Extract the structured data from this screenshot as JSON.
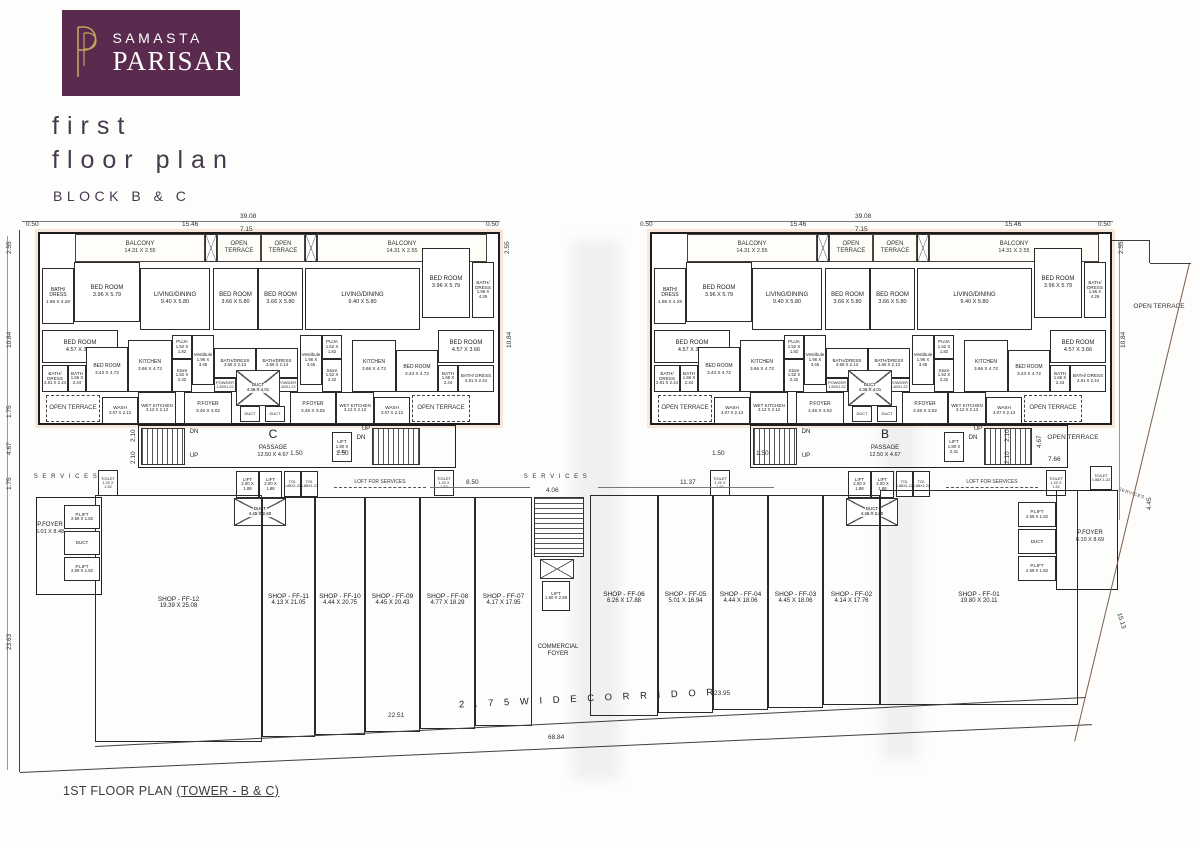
{
  "header": {
    "brand_line1": "SAMASTA",
    "brand_line2": "PARISAR",
    "title_line1": "first",
    "title_line2": "floor plan",
    "subtitle": "BLOCK B & C",
    "logo_bg": "#5a2b4e",
    "logo_gold": "#c9a15f",
    "title_color": "#46394e"
  },
  "footer": {
    "caption_plain": "1ST FLOOR PLAN ",
    "caption_underline": "(TOWER - B & C)"
  },
  "plan": {
    "oy": 232,
    "towers": [
      {
        "id": "C",
        "ox": 38
      },
      {
        "id": "B",
        "ox": 650
      }
    ],
    "tower_rooms": [
      {
        "c": "room open",
        "n": "BALCONY",
        "d": "14.31 X 2.55",
        "x": 37,
        "y": 2,
        "w": 130,
        "h": 28
      },
      {
        "c": "xbox",
        "x": 167,
        "y": 2,
        "w": 12,
        "h": 28
      },
      {
        "c": "room open",
        "n": "OPEN TERRACE",
        "x": 179,
        "y": 2,
        "w": 44,
        "h": 28
      },
      {
        "c": "room open",
        "n": "OPEN TERRACE",
        "x": 223,
        "y": 2,
        "w": 44,
        "h": 28
      },
      {
        "c": "xbox",
        "x": 267,
        "y": 2,
        "w": 12,
        "h": 28
      },
      {
        "c": "room open",
        "n": "BALCONY",
        "d": "14.31 X 2.55",
        "x": 279,
        "y": 2,
        "w": 170,
        "h": 28
      },
      {
        "c": "room sm",
        "n": "BATH/ DRESS",
        "d": "1.96 X 4.29",
        "x": 4,
        "y": 36,
        "w": 32,
        "h": 56
      },
      {
        "c": "room",
        "n": "BED ROOM",
        "d": "3.96 X 5.79",
        "x": 36,
        "y": 30,
        "w": 66,
        "h": 60
      },
      {
        "c": "room",
        "n": "LIVING/DINING",
        "d": "9.40 X 5.80",
        "x": 102,
        "y": 36,
        "w": 70,
        "h": 62
      },
      {
        "c": "room",
        "n": "BED ROOM",
        "d": "3.66 X 5.80",
        "x": 175,
        "y": 36,
        "w": 45,
        "h": 62
      },
      {
        "c": "room",
        "n": "BED ROOM",
        "d": "3.66 X 5.80",
        "x": 220,
        "y": 36,
        "w": 45,
        "h": 62
      },
      {
        "c": "room",
        "n": "LIVING/DINING",
        "d": "9.40 X 5.80",
        "x": 267,
        "y": 36,
        "w": 115,
        "h": 62
      },
      {
        "c": "room",
        "n": "BED ROOM",
        "d": "3.96 X 5.79",
        "x": 384,
        "y": 16,
        "w": 48,
        "h": 70
      },
      {
        "c": "room xs",
        "n": "BATH/ DRESS",
        "d": "1.96 X 4.29",
        "x": 434,
        "y": 30,
        "w": 22,
        "h": 56
      },
      {
        "c": "room",
        "n": "BED ROOM",
        "d": "4.57 X 3.66",
        "x": 4,
        "y": 98,
        "w": 76,
        "h": 33
      },
      {
        "c": "room xs",
        "n": "BATH/ DRESS",
        "d": "2.81 X 2.44",
        "x": 4,
        "y": 133,
        "w": 26,
        "h": 27
      },
      {
        "c": "room xs",
        "n": "BATH",
        "d": "1.66 X 2.44",
        "x": 30,
        "y": 133,
        "w": 18,
        "h": 27
      },
      {
        "c": "room sm",
        "n": "BED ROOM",
        "d": "3.43 X 4.72",
        "x": 48,
        "y": 115,
        "w": 42,
        "h": 45
      },
      {
        "c": "room sm",
        "n": "KITCHEN",
        "d": "3.66 X 4.72",
        "x": 90,
        "y": 108,
        "w": 44,
        "h": 52
      },
      {
        "c": "room xs",
        "n": "PUJA",
        "d": "1.52 X 1.82",
        "x": 134,
        "y": 103,
        "w": 20,
        "h": 24
      },
      {
        "c": "room xs",
        "n": "Store",
        "d": "1.52 X 2.32",
        "x": 134,
        "y": 127,
        "w": 20,
        "h": 33
      },
      {
        "c": "room xs",
        "n": "Vestibule",
        "d": "1.96 X 3.45",
        "x": 154,
        "y": 103,
        "w": 22,
        "h": 50
      },
      {
        "c": "room xs",
        "n": "BATH/DRESS",
        "d": "3.66 X 2.13",
        "x": 176,
        "y": 116,
        "w": 42,
        "h": 30
      },
      {
        "c": "room xs",
        "n": "BATH/DRESS",
        "d": "3.66 X 2.13",
        "x": 218,
        "y": 116,
        "w": 42,
        "h": 30
      },
      {
        "c": "room xxs",
        "n": "POWDER",
        "d": "1.60X1.22",
        "x": 176,
        "y": 146,
        "w": 22,
        "h": 14
      },
      {
        "c": "room xxs",
        "n": "POWDER",
        "d": "1.60X1.22",
        "x": 238,
        "y": 146,
        "w": 22,
        "h": 14
      },
      {
        "c": "xbox",
        "n": "DUCT",
        "d": "4.36 X 4.01",
        "x": 198,
        "y": 138,
        "w": 44,
        "h": 36
      },
      {
        "c": "room xs",
        "n": "Vestibule",
        "d": "1.96 X 3.45",
        "x": 262,
        "y": 103,
        "w": 22,
        "h": 50
      },
      {
        "c": "room xs",
        "n": "PUJA",
        "d": "1.52 X 1.82",
        "x": 284,
        "y": 103,
        "w": 20,
        "h": 24
      },
      {
        "c": "room xs",
        "n": "Store",
        "d": "1.52 X 2.32",
        "x": 284,
        "y": 127,
        "w": 20,
        "h": 33
      },
      {
        "c": "room sm",
        "n": "KITCHEN",
        "d": "3.66 X 4.72",
        "x": 314,
        "y": 108,
        "w": 44,
        "h": 52
      },
      {
        "c": "room sm",
        "n": "BED ROOM",
        "d": "3.43 X 4.72",
        "x": 358,
        "y": 118,
        "w": 42,
        "h": 42
      },
      {
        "c": "room",
        "n": "BED ROOM",
        "d": "4.57 X 3.66",
        "x": 400,
        "y": 98,
        "w": 56,
        "h": 33
      },
      {
        "c": "room xs",
        "n": "BATH",
        "d": "1.66 X 2.44",
        "x": 400,
        "y": 133,
        "w": 20,
        "h": 27
      },
      {
        "c": "room xs",
        "n": "BATH/ DRESS",
        "d": "2.81 X 2.44",
        "x": 420,
        "y": 133,
        "w": 36,
        "h": 27
      },
      {
        "c": "room open dash",
        "n": "OPEN TERRACE",
        "x": 8,
        "y": 163,
        "w": 54,
        "h": 27
      },
      {
        "c": "room xs",
        "n": "WASH",
        "d": "3.07 X 2.13",
        "x": 64,
        "y": 165,
        "w": 36,
        "h": 27
      },
      {
        "c": "room xs",
        "n": "WET KITCHEN",
        "d": "3.12 X 2.13",
        "x": 100,
        "y": 160,
        "w": 38,
        "h": 32
      },
      {
        "c": "room sm",
        "n": "P.FOYER",
        "d": "3.46 X 3.02",
        "x": 146,
        "y": 160,
        "w": 48,
        "h": 32
      },
      {
        "c": "room xxs",
        "n": "DUCT",
        "x": 202,
        "y": 174,
        "w": 20,
        "h": 16
      },
      {
        "c": "room xxs",
        "n": "DUCT",
        "x": 227,
        "y": 174,
        "w": 20,
        "h": 16
      },
      {
        "c": "room sm",
        "n": "P.FOYER",
        "d": "3.46 X 3.02",
        "x": 252,
        "y": 160,
        "w": 46,
        "h": 32
      },
      {
        "c": "room xs",
        "n": "WET KITCHEN",
        "d": "3.12 X 2.13",
        "x": 298,
        "y": 160,
        "w": 38,
        "h": 32
      },
      {
        "c": "room xs",
        "n": "WASH",
        "d": "3.07 X 2.13",
        "x": 336,
        "y": 165,
        "w": 36,
        "h": 27
      },
      {
        "c": "room open dash",
        "n": "OPEN TERRACE",
        "x": 374,
        "y": 163,
        "w": 58,
        "h": 27
      },
      {
        "c": "outline",
        "x": 100,
        "y": 193,
        "w": 318,
        "h": 43
      },
      {
        "c": "stairs",
        "x": 103,
        "y": 196,
        "w": 44,
        "h": 37
      },
      {
        "c": "txt",
        "n": "DN",
        "x": 148,
        "y": 197,
        "w": 16,
        "h": 8
      },
      {
        "c": "txt",
        "n": "UP",
        "x": 148,
        "y": 221,
        "w": 16,
        "h": 8
      },
      {
        "c": "txt big",
        "n": "{id}",
        "x": 215,
        "y": 195,
        "w": 40,
        "h": 14
      },
      {
        "c": "txt",
        "n": "PASSAGE",
        "d": "12.50 X 4.67",
        "x": 200,
        "y": 210,
        "w": 70,
        "h": 20
      },
      {
        "c": "room xs",
        "n": "LIFT",
        "d": "1.80 X 2.31",
        "x": 294,
        "y": 200,
        "w": 20,
        "h": 30
      },
      {
        "c": "txt",
        "n": "UP",
        "x": 320,
        "y": 194,
        "w": 16,
        "h": 8
      },
      {
        "c": "txt",
        "n": "DN",
        "x": 315,
        "y": 203,
        "w": 16,
        "h": 8
      },
      {
        "c": "stairs",
        "x": 334,
        "y": 196,
        "w": 48,
        "h": 37
      },
      {
        "c": "room xxs",
        "n": "TOILET",
        "d": "1.20 X 1.52",
        "x": 60,
        "y": 238,
        "w": 20,
        "h": 26
      },
      {
        "c": "room xs",
        "n": "LIFT",
        "d": "2.00 X 1.88",
        "x": 198,
        "y": 239,
        "w": 23,
        "h": 27
      },
      {
        "c": "room xs",
        "n": "LIFT",
        "d": "2.00 X 1.88",
        "x": 221,
        "y": 239,
        "w": 23,
        "h": 27
      },
      {
        "c": "room xxs",
        "n": "TOI.",
        "d": "1.88X1.22",
        "x": 246,
        "y": 239,
        "w": 17,
        "h": 26
      },
      {
        "c": "room xxs",
        "n": "TOI.",
        "d": "1.88X1.22",
        "x": 263,
        "y": 239,
        "w": 17,
        "h": 26
      },
      {
        "c": "txt dashu",
        "n": "LOFT FOR SERVICES",
        "x": 296,
        "y": 246,
        "w": 92,
        "h": 10
      },
      {
        "c": "room xxs",
        "n": "TOILET",
        "d": "1.20 X 1.52",
        "x": 396,
        "y": 238,
        "w": 20,
        "h": 26
      },
      {
        "c": "xbox",
        "n": "DUCT",
        "d": "4.45 X 2.60",
        "x": 196,
        "y": 266,
        "w": 52,
        "h": 28
      }
    ],
    "items": [
      {
        "c": "room shop tall",
        "n": "SHOP - FF-12",
        "d": "19.39 X 25.08",
        "x": 95,
        "y": 495,
        "w": 167,
        "h": 247
      },
      {
        "c": "room shop",
        "n": "SHOP - FF-11",
        "d": "4.13 X 21.05",
        "x": 262,
        "y": 497,
        "w": 53,
        "h": 240
      },
      {
        "c": "room shop",
        "n": "SHOP - FF-10",
        "d": "4.44 X 20.75",
        "x": 315,
        "y": 497,
        "w": 50,
        "h": 238
      },
      {
        "c": "room shop",
        "n": "SHOP - FF-09",
        "d": "4.45 X 20.43",
        "x": 365,
        "y": 497,
        "w": 55,
        "h": 235
      },
      {
        "c": "room shop",
        "n": "SHOP - FF-08",
        "d": "4.77 X 18.29",
        "x": 420,
        "y": 497,
        "w": 55,
        "h": 232
      },
      {
        "c": "room shop",
        "n": "SHOP - FF-07",
        "d": "4.17 X 17.95",
        "x": 475,
        "y": 497,
        "w": 57,
        "h": 229
      },
      {
        "c": "room shop",
        "n": "SHOP - FF-06",
        "d": "6.26 X 17.88",
        "x": 590,
        "y": 495,
        "w": 68,
        "h": 221
      },
      {
        "c": "room shop",
        "n": "SHOP - FF-05",
        "d": "5.01 X 16.94",
        "x": 658,
        "y": 495,
        "w": 55,
        "h": 218
      },
      {
        "c": "room shop",
        "n": "SHOP - FF-04",
        "d": "4.44 X 18.06",
        "x": 713,
        "y": 495,
        "w": 55,
        "h": 215
      },
      {
        "c": "room shop",
        "n": "SHOP - FF-03",
        "d": "4.45 X 18.06",
        "x": 768,
        "y": 495,
        "w": 55,
        "h": 213
      },
      {
        "c": "room shop",
        "n": "SHOP - FF-02",
        "d": "4.14 X 17.76",
        "x": 823,
        "y": 495,
        "w": 57,
        "h": 210
      },
      {
        "c": "room shop tall",
        "n": "SHOP - FF-01",
        "d": "19.80 X 20.11",
        "x": 880,
        "y": 490,
        "w": 198,
        "h": 215
      },
      {
        "c": "stairs v",
        "x": 534,
        "y": 497,
        "w": 50,
        "h": 60
      },
      {
        "c": "xbox",
        "x": 540,
        "y": 559,
        "w": 34,
        "h": 20
      },
      {
        "c": "room xs",
        "n": "LIFT",
        "d": "1.80 X 2.59",
        "x": 542,
        "y": 581,
        "w": 28,
        "h": 30
      },
      {
        "c": "txt",
        "n": "COMMERCIAL FOYER",
        "x": 528,
        "y": 640,
        "w": 60,
        "h": 22
      },
      {
        "c": "txt sp",
        "n": "S E R V I C E S",
        "x": 28,
        "y": 473,
        "w": 76,
        "h": 9
      },
      {
        "c": "outline thin",
        "x": 36,
        "y": 497,
        "w": 66,
        "h": 98
      },
      {
        "c": "txt",
        "n": "P.FOYER",
        "d": "6.01 X 8.48",
        "x": 34,
        "y": 518,
        "w": 32,
        "h": 22
      },
      {
        "c": "room xs",
        "n": "P.LIFT",
        "d": "2.59 X 1.82",
        "x": 64,
        "y": 505,
        "w": 36,
        "h": 24
      },
      {
        "c": "room xs",
        "n": "DUCT",
        "x": 64,
        "y": 531,
        "w": 36,
        "h": 24
      },
      {
        "c": "room xs",
        "n": "P.LIFT",
        "d": "2.59 X 1.82",
        "x": 64,
        "y": 557,
        "w": 36,
        "h": 24
      },
      {
        "c": "outline thin",
        "x": 1056,
        "y": 490,
        "w": 62,
        "h": 100
      },
      {
        "c": "txt",
        "n": "P.FOYER",
        "d": "6.10 X 8.69",
        "x": 1068,
        "y": 526,
        "w": 44,
        "h": 22
      },
      {
        "c": "room xs",
        "n": "P.LIFT",
        "d": "2.59 X 1.82",
        "x": 1018,
        "y": 502,
        "w": 38,
        "h": 25
      },
      {
        "c": "room xs",
        "n": "DUCT",
        "x": 1018,
        "y": 529,
        "w": 38,
        "h": 25
      },
      {
        "c": "room xs",
        "n": "P.LIFT",
        "d": "2.59 X 1.82",
        "x": 1018,
        "y": 556,
        "w": 38,
        "h": 25
      },
      {
        "c": "room xxs",
        "n": "TOILET",
        "d": "1.88X 1.22",
        "x": 1090,
        "y": 466,
        "w": 22,
        "h": 24
      },
      {
        "c": "txt rot",
        "n": "SERVICES",
        "x": 1112,
        "y": 482,
        "w": 44,
        "h": 9
      },
      {
        "c": "txt ot",
        "n": "OPEN TERRACE",
        "x": 1128,
        "y": 296,
        "w": 62,
        "h": 22
      },
      {
        "c": "txt ot",
        "n": "OPEN TERRACE",
        "x": 1040,
        "y": 427,
        "w": 66,
        "h": 22
      },
      {
        "c": "txt sp",
        "n": "S E R V I C E S",
        "x": 518,
        "y": 473,
        "w": 76,
        "h": 9
      },
      {
        "c": "txt corridor",
        "n": "2 . 7 5   W I D E   C O R R I D O R",
        "x": 368,
        "y": 702,
        "w": 440,
        "h": 16
      }
    ],
    "lines": [
      {
        "x": 20,
        "y": 230,
        "len": 542,
        "a": 90
      },
      {
        "x": 8,
        "y": 236,
        "len": 534,
        "a": 90,
        "w": 0.5,
        "col": "#999999"
      },
      {
        "x": 20,
        "y": 772,
        "len": 1073,
        "a": -2.56
      },
      {
        "x": 95,
        "y": 746,
        "len": 992,
        "a": -2.83
      },
      {
        "x": 1190,
        "y": 263,
        "len": 492,
        "a": 103.5,
        "col": "#7a5c49"
      },
      {
        "x": 1112,
        "y": 240,
        "len": 38,
        "a": 0
      },
      {
        "x": 1150,
        "y": 240,
        "len": 23,
        "a": 90
      },
      {
        "x": 1150,
        "y": 263,
        "len": 41,
        "a": 0
      },
      {
        "x": 22,
        "y": 221,
        "len": 478,
        "a": 0,
        "w": 0.5,
        "col": "#777777"
      },
      {
        "x": 645,
        "y": 221,
        "len": 468,
        "a": 0,
        "w": 0.5,
        "col": "#777777"
      },
      {
        "x": 430,
        "y": 487,
        "len": 100,
        "a": 0,
        "w": 0.5,
        "col": "#777777"
      },
      {
        "x": 598,
        "y": 487,
        "len": 176,
        "a": 0,
        "w": 0.5,
        "col": "#777777"
      },
      {
        "x": 1120,
        "y": 242,
        "len": 278,
        "a": 90,
        "w": 0.5,
        "col": "#999999"
      }
    ],
    "dims": [
      {
        "t": "39.08",
        "x": 240,
        "y": 213
      },
      {
        "t": "0.50",
        "x": 26,
        "y": 221
      },
      {
        "t": "15.46",
        "x": 182,
        "y": 221
      },
      {
        "t": "7.15",
        "x": 240,
        "y": 226
      },
      {
        "t": "0.50",
        "x": 486,
        "y": 221
      },
      {
        "t": "2.55",
        "x": 504,
        "y": 254,
        "r": -90
      },
      {
        "t": "10.84",
        "x": 506,
        "y": 348,
        "r": -90
      },
      {
        "t": "39.08",
        "x": 855,
        "y": 213
      },
      {
        "t": "0.50",
        "x": 640,
        "y": 221
      },
      {
        "t": "15.46",
        "x": 790,
        "y": 221
      },
      {
        "t": "7.15",
        "x": 855,
        "y": 226
      },
      {
        "t": "15.46",
        "x": 1005,
        "y": 221
      },
      {
        "t": "0.50",
        "x": 1098,
        "y": 221
      },
      {
        "t": "2.55",
        "x": 1118,
        "y": 254,
        "r": -90
      },
      {
        "t": "10.84",
        "x": 1120,
        "y": 348,
        "r": -90
      },
      {
        "t": "2.55",
        "x": 6,
        "y": 254,
        "r": -90
      },
      {
        "t": "10.84",
        "x": 6,
        "y": 348,
        "r": -90
      },
      {
        "t": "1.75",
        "x": 6,
        "y": 418,
        "r": -90
      },
      {
        "t": "4.67",
        "x": 6,
        "y": 455,
        "r": -90
      },
      {
        "t": "1.75",
        "x": 6,
        "y": 490,
        "r": -90
      },
      {
        "t": "23.63",
        "x": 6,
        "y": 650,
        "r": -90
      },
      {
        "t": "2.10",
        "x": 130,
        "y": 442,
        "r": -90
      },
      {
        "t": "2.10",
        "x": 130,
        "y": 464,
        "r": -90
      },
      {
        "t": "1.50",
        "x": 290,
        "y": 450
      },
      {
        "t": "1.50",
        "x": 336,
        "y": 450
      },
      {
        "t": "1.50",
        "x": 712,
        "y": 450
      },
      {
        "t": "1.50",
        "x": 756,
        "y": 450
      },
      {
        "t": "2.10",
        "x": 1004,
        "y": 442,
        "r": -90
      },
      {
        "t": "2.10",
        "x": 1004,
        "y": 464,
        "r": -90
      },
      {
        "t": "8.50",
        "x": 466,
        "y": 479
      },
      {
        "t": "4.06",
        "x": 546,
        "y": 487
      },
      {
        "t": "11.37",
        "x": 680,
        "y": 479
      },
      {
        "t": "7.66",
        "x": 1048,
        "y": 456
      },
      {
        "t": "4.67",
        "x": 1036,
        "y": 448,
        "r": -90
      },
      {
        "t": "4.45",
        "x": 1146,
        "y": 510,
        "r": -90
      },
      {
        "t": "15.13",
        "x": 1122,
        "y": 612,
        "r": 72
      },
      {
        "t": "22.51",
        "x": 388,
        "y": 712
      },
      {
        "t": "23.95",
        "x": 714,
        "y": 690
      },
      {
        "t": "68.84",
        "x": 548,
        "y": 734
      }
    ]
  }
}
